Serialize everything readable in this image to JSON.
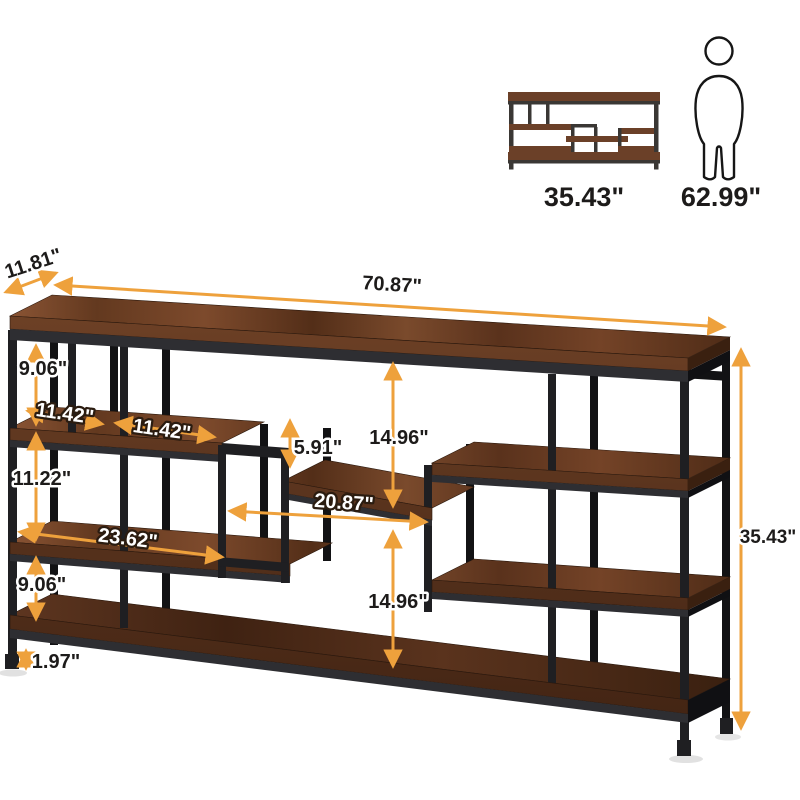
{
  "reference_icons": {
    "shelf_front_width_label": "35.43\"",
    "person_height_label": "62.99\""
  },
  "dimensions": {
    "depth": "11.81\"",
    "width": "70.87\"",
    "top_left_gap": "9.06\"",
    "cubby_a": "11.42\"",
    "cubby_b": "11.42\"",
    "shelf_gap_small": "5.91\"",
    "center_upper_gap": "14.96\"",
    "left_middle_gap": "11.22\"",
    "middle_shelf_width": "20.87\"",
    "lower_left_shelf_width": "23.62\"",
    "left_lower_gap": "9.06\"",
    "center_lower_gap": "14.96\"",
    "bottom_clearance": "1.97\"",
    "overall_height": "35.43\""
  },
  "colors": {
    "arrow": "#EEA13C",
    "label_dark": "#1D1B1A",
    "label_light": "#FFFFFF",
    "wood_mid": "#6B3E26",
    "wood_dark": "#46281A",
    "metal": "#1F1F22",
    "background": "#FFFFFF"
  }
}
